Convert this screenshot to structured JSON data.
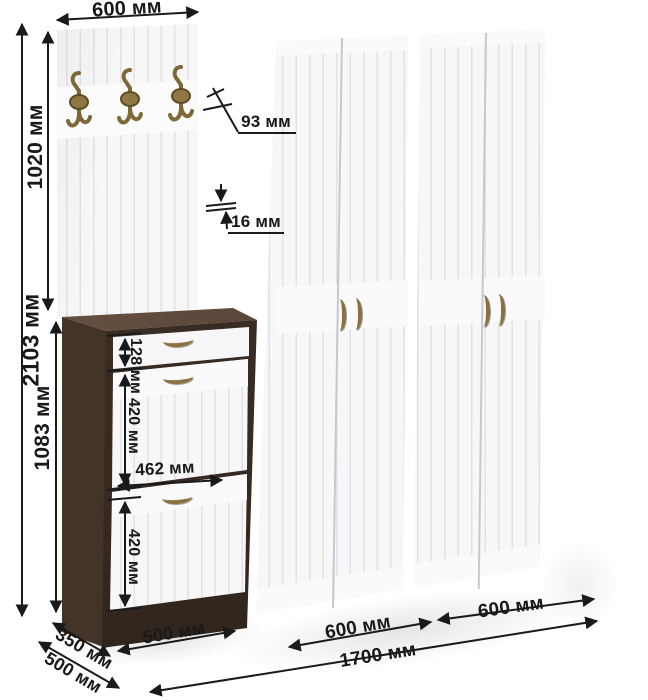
{
  "diagram": "furniture-dimension-drawing",
  "dims": {
    "panel_width_top": "600 мм",
    "total_height": "2103 мм",
    "panel_height": "1020 мм",
    "cabinet_height": "1083 мм",
    "edge_depth": "93 мм",
    "edge_thickness": "16 мм",
    "drawer_height": "128 мм",
    "flap1_height": "420 мм",
    "inner_width": "462 мм",
    "flap2_height": "420 мм",
    "cabinet_depth": "350 мм",
    "wardrobe_depth": "500 мм",
    "cabinet_width": "500 мм",
    "wardrobe1_width": "600 мм",
    "wardrobe2_width": "600 мм",
    "total_width": "1700 мм"
  },
  "icons": {
    "coat_hook": "coat-hook-icon",
    "wardrobe_handle": "door-handle-icon",
    "cabinet_handle": "drawer-handle-icon"
  },
  "colors": {
    "wood_dark": "#382b24",
    "wood_top": "#55443a",
    "door_white": "#f7f7f8",
    "groove": "#e1e1e6",
    "brass": "#8a7140",
    "dim_line": "#1a1a1a"
  }
}
